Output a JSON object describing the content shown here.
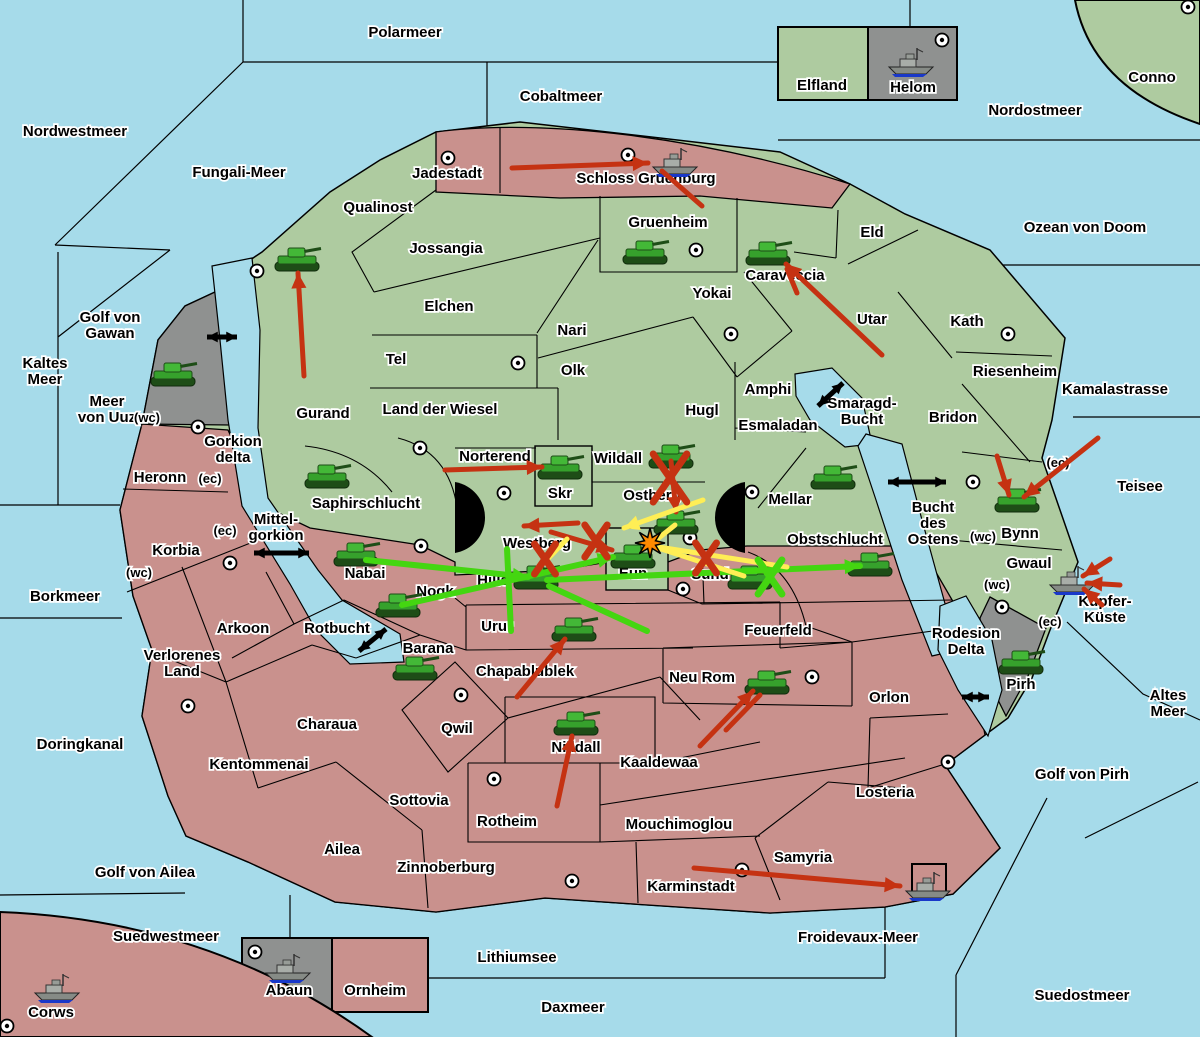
{
  "colors": {
    "sea": "#A6DBEA",
    "land_green": "#AECBA0",
    "land_pink": "#C9918D",
    "land_gray": "#8F9190",
    "border": "#000000",
    "halo": "#FFFFFF",
    "text": "#000000",
    "attack_red": "#C53212",
    "attack_green": "#44D611",
    "attack_yellow": "#FFEE55",
    "strait_black": "#000000",
    "explosion": "#FF8A00",
    "ship_blue": "#1938C9"
  },
  "sea_labels": [
    {
      "name": "Nordwestmeer",
      "x": 75,
      "y": 136
    },
    {
      "name": "Polarmeer",
      "x": 405,
      "y": 37
    },
    {
      "name": "Cobaltmeer",
      "x": 561,
      "y": 101
    },
    {
      "name": "Fungali-Meer",
      "x": 239,
      "y": 177
    },
    {
      "name": "Nordostmeer",
      "x": 1035,
      "y": 115
    },
    {
      "name": "Ozean von Doom",
      "x": 1085,
      "y": 232
    },
    {
      "name": "Golf von Gawan",
      "x": 110,
      "y": 322,
      "lines": [
        "Golf von",
        "Gawan"
      ]
    },
    {
      "name": "Kaltes Meer",
      "x": 45,
      "y": 368,
      "lines": [
        "Kaltes",
        "Meer"
      ]
    },
    {
      "name": "Meer von Uuz",
      "x": 107,
      "y": 406,
      "lines": [
        "Meer",
        "von Uuz"
      ]
    },
    {
      "name": "Gorkion delta",
      "x": 233,
      "y": 446,
      "lines": [
        "Gorkion",
        "delta"
      ]
    },
    {
      "name": "Mittel-gorkion",
      "x": 276,
      "y": 524,
      "lines": [
        "Mittel-",
        "gorkion"
      ]
    },
    {
      "name": "Borkmeer",
      "x": 65,
      "y": 601
    },
    {
      "name": "Rotbucht",
      "x": 337,
      "y": 633
    },
    {
      "name": "Smaragd-Bucht",
      "x": 862,
      "y": 408,
      "lines": [
        "Smaragd-",
        "Bucht"
      ]
    },
    {
      "name": "Bucht des Ostens",
      "x": 933,
      "y": 512,
      "lines": [
        "Bucht",
        "des",
        "Ostens"
      ]
    },
    {
      "name": "Kamalastrasse",
      "x": 1115,
      "y": 394
    },
    {
      "name": "Teisee",
      "x": 1140,
      "y": 491
    },
    {
      "name": "Kupfer-Küste",
      "x": 1105,
      "y": 606,
      "lines": [
        "Kupfer-",
        "Küste"
      ]
    },
    {
      "name": "Altes Meer",
      "x": 1168,
      "y": 700,
      "lines": [
        "Altes",
        "Meer"
      ]
    },
    {
      "name": "Rodesion Delta",
      "x": 966,
      "y": 638,
      "lines": [
        "Rodesion",
        "Delta"
      ]
    },
    {
      "name": "Golf von Pirh",
      "x": 1082,
      "y": 779
    },
    {
      "name": "Doringkanal",
      "x": 80,
      "y": 749
    },
    {
      "name": "Golf von Ailea",
      "x": 145,
      "y": 877
    },
    {
      "name": "Suedwestmeer",
      "x": 166,
      "y": 941
    },
    {
      "name": "Lithiumsee",
      "x": 517,
      "y": 962
    },
    {
      "name": "Daxmeer",
      "x": 573,
      "y": 1012
    },
    {
      "name": "Froidevaux-Meer",
      "x": 858,
      "y": 942
    },
    {
      "name": "Suedostmeer",
      "x": 1082,
      "y": 1000
    }
  ],
  "territory_labels": [
    {
      "name": "Jadestadt",
      "x": 447,
      "y": 178
    },
    {
      "name": "Schloss Gruenburg",
      "x": 646,
      "y": 183
    },
    {
      "name": "Elfland",
      "x": 822,
      "y": 90
    },
    {
      "name": "Helom",
      "x": 913,
      "y": 92
    },
    {
      "name": "Conno",
      "x": 1152,
      "y": 82
    },
    {
      "name": "Qualinost",
      "x": 378,
      "y": 212
    },
    {
      "name": "Jossangia",
      "x": 446,
      "y": 253
    },
    {
      "name": "Gruenheim",
      "x": 668,
      "y": 227
    },
    {
      "name": "Eld",
      "x": 872,
      "y": 237
    },
    {
      "name": "Caraveccia",
      "x": 785,
      "y": 280
    },
    {
      "name": "Yokai",
      "x": 712,
      "y": 298
    },
    {
      "name": "Utar",
      "x": 872,
      "y": 324
    },
    {
      "name": "Kath",
      "x": 967,
      "y": 326
    },
    {
      "name": "Riesenheim",
      "x": 1015,
      "y": 376
    },
    {
      "name": "Bridon",
      "x": 953,
      "y": 422
    },
    {
      "name": "Elchen",
      "x": 449,
      "y": 311
    },
    {
      "name": "Nari",
      "x": 572,
      "y": 335
    },
    {
      "name": "Tel",
      "x": 396,
      "y": 364
    },
    {
      "name": "Olk",
      "x": 573,
      "y": 375
    },
    {
      "name": "Land der Wiesel",
      "x": 440,
      "y": 414
    },
    {
      "name": "Hugl",
      "x": 702,
      "y": 415
    },
    {
      "name": "Amphi",
      "x": 768,
      "y": 394
    },
    {
      "name": "Esmaladan",
      "x": 778,
      "y": 430
    },
    {
      "name": "Gurand",
      "x": 323,
      "y": 418
    },
    {
      "name": "Norterend",
      "x": 495,
      "y": 461
    },
    {
      "name": "Skr",
      "x": 560,
      "y": 498
    },
    {
      "name": "Wildall",
      "x": 618,
      "y": 463
    },
    {
      "name": "Ostberg",
      "x": 652,
      "y": 500
    },
    {
      "name": "Mellar",
      "x": 790,
      "y": 504
    },
    {
      "name": "Westberg",
      "x": 537,
      "y": 548
    },
    {
      "name": "Eun",
      "x": 633,
      "y": 578
    },
    {
      "name": "Sund",
      "x": 710,
      "y": 579
    },
    {
      "name": "Saphirschlucht",
      "x": 366,
      "y": 508
    },
    {
      "name": "Nabai",
      "x": 365,
      "y": 578
    },
    {
      "name": "Nogk",
      "x": 435,
      "y": 596
    },
    {
      "name": "Hills",
      "x": 493,
      "y": 585
    },
    {
      "name": "Obstschlucht",
      "x": 835,
      "y": 544
    },
    {
      "name": "Bynn",
      "x": 1020,
      "y": 538
    },
    {
      "name": "Gwaul",
      "x": 1029,
      "y": 568
    },
    {
      "name": "Pirh",
      "x": 1021,
      "y": 689
    },
    {
      "name": "Heronn",
      "x": 160,
      "y": 482
    },
    {
      "name": "Korbia",
      "x": 176,
      "y": 555
    },
    {
      "name": "Arkoon",
      "x": 243,
      "y": 633
    },
    {
      "name": "Verlorenes Land",
      "x": 182,
      "y": 660,
      "lines": [
        "Verlorenes",
        "Land"
      ]
    },
    {
      "name": "Kentommenai",
      "x": 259,
      "y": 769
    },
    {
      "name": "Charaua",
      "x": 327,
      "y": 729
    },
    {
      "name": "Ailea",
      "x": 342,
      "y": 854
    },
    {
      "name": "Sottovia",
      "x": 419,
      "y": 805
    },
    {
      "name": "Zinnoberburg",
      "x": 446,
      "y": 872
    },
    {
      "name": "Qwil",
      "x": 457,
      "y": 733
    },
    {
      "name": "Rotheim",
      "x": 507,
      "y": 826
    },
    {
      "name": "Barana",
      "x": 428,
      "y": 653
    },
    {
      "name": "Urur",
      "x": 497,
      "y": 631
    },
    {
      "name": "Chapablublek",
      "x": 525,
      "y": 676
    },
    {
      "name": "Nilldall",
      "x": 576,
      "y": 752
    },
    {
      "name": "Kaaldewaa",
      "x": 659,
      "y": 767
    },
    {
      "name": "Neu Rom",
      "x": 702,
      "y": 682
    },
    {
      "name": "Feuerfeld",
      "x": 778,
      "y": 635
    },
    {
      "name": "Mouchimoglou",
      "x": 679,
      "y": 829
    },
    {
      "name": "Karminstadt",
      "x": 691,
      "y": 891
    },
    {
      "name": "Samyria",
      "x": 803,
      "y": 862
    },
    {
      "name": "Orlon",
      "x": 889,
      "y": 702
    },
    {
      "name": "Losteria",
      "x": 885,
      "y": 797
    },
    {
      "name": "Corws",
      "x": 51,
      "y": 1017
    },
    {
      "name": "Abaun",
      "x": 289,
      "y": 995
    },
    {
      "name": "Ornheim",
      "x": 375,
      "y": 995
    }
  ],
  "zone_markers": [
    {
      "text": "(wc)",
      "x": 147,
      "y": 422
    },
    {
      "text": "(ec)",
      "x": 210,
      "y": 483
    },
    {
      "text": "(ec)",
      "x": 225,
      "y": 535
    },
    {
      "text": "(wc)",
      "x": 139,
      "y": 577
    },
    {
      "text": "(wc)",
      "x": 983,
      "y": 541
    },
    {
      "text": "(ec)",
      "x": 1058,
      "y": 467
    },
    {
      "text": "(wc)",
      "x": 997,
      "y": 589
    },
    {
      "text": "(ec)",
      "x": 1050,
      "y": 626
    }
  ],
  "capital_dots": [
    [
      448,
      158
    ],
    [
      628,
      155
    ],
    [
      942,
      40
    ],
    [
      1188,
      7
    ],
    [
      257,
      271
    ],
    [
      198,
      427
    ],
    [
      518,
      363
    ],
    [
      731,
      334
    ],
    [
      1008,
      334
    ],
    [
      696,
      250
    ],
    [
      420,
      448
    ],
    [
      504,
      493
    ],
    [
      421,
      546
    ],
    [
      752,
      492
    ],
    [
      690,
      538
    ],
    [
      683,
      589
    ],
    [
      973,
      482
    ],
    [
      1002,
      607
    ],
    [
      230,
      563
    ],
    [
      188,
      706
    ],
    [
      461,
      695
    ],
    [
      494,
      779
    ],
    [
      572,
      881
    ],
    [
      742,
      870
    ],
    [
      812,
      677
    ],
    [
      948,
      762
    ],
    [
      7,
      1026
    ],
    [
      255,
      952
    ]
  ],
  "tanks": [
    [
      297,
      260
    ],
    [
      173,
      375
    ],
    [
      645,
      253
    ],
    [
      768,
      254
    ],
    [
      327,
      477
    ],
    [
      560,
      468
    ],
    [
      671,
      457
    ],
    [
      676,
      523
    ],
    [
      833,
      478
    ],
    [
      633,
      557
    ],
    [
      750,
      578
    ],
    [
      536,
      578
    ],
    [
      356,
      555
    ],
    [
      398,
      606
    ],
    [
      870,
      565
    ],
    [
      1017,
      501
    ],
    [
      1021,
      663
    ],
    [
      574,
      630
    ],
    [
      415,
      669
    ],
    [
      576,
      724
    ],
    [
      767,
      683
    ]
  ],
  "ships": [
    [
      675,
      162
    ],
    [
      911,
      62
    ],
    [
      1072,
      580
    ],
    [
      928,
      886
    ],
    [
      57,
      988
    ],
    [
      288,
      968
    ]
  ],
  "strait_arrows": [
    [
      207,
      337,
      237,
      337
    ],
    [
      818,
      406,
      843,
      383
    ],
    [
      888,
      482,
      946,
      482
    ],
    [
      254,
      553,
      309,
      553
    ],
    [
      359,
      651,
      386,
      629
    ],
    [
      962,
      697,
      989,
      697
    ]
  ],
  "attack_arrows": [
    {
      "color": "red",
      "x1": 512,
      "y1": 168,
      "x2": 648,
      "y2": 163,
      "head": true
    },
    {
      "color": "red",
      "x1": 702,
      "y1": 206,
      "x2": 662,
      "y2": 171,
      "head": false
    },
    {
      "color": "red",
      "x1": 304,
      "y1": 376,
      "x2": 298,
      "y2": 273,
      "head": true
    },
    {
      "color": "red",
      "x1": 882,
      "y1": 355,
      "x2": 786,
      "y2": 264,
      "head": true
    },
    {
      "color": "red",
      "x1": 797,
      "y1": 293,
      "x2": 787,
      "y2": 269,
      "head": false
    },
    {
      "color": "red",
      "x1": 445,
      "y1": 470,
      "x2": 542,
      "y2": 467,
      "head": true
    },
    {
      "color": "red",
      "x1": 671,
      "y1": 461,
      "x2": 676,
      "y2": 512,
      "head": true
    },
    {
      "color": "red",
      "x1": 578,
      "y1": 523,
      "x2": 524,
      "y2": 526,
      "head": true
    },
    {
      "color": "red",
      "x1": 551,
      "y1": 532,
      "x2": 612,
      "y2": 550,
      "head": true
    },
    {
      "color": "red",
      "x1": 997,
      "y1": 456,
      "x2": 1009,
      "y2": 495,
      "head": true
    },
    {
      "color": "red",
      "x1": 1098,
      "y1": 438,
      "x2": 1024,
      "y2": 497,
      "head": true
    },
    {
      "color": "red",
      "x1": 1110,
      "y1": 559,
      "x2": 1083,
      "y2": 576,
      "head": true
    },
    {
      "color": "red",
      "x1": 1120,
      "y1": 585,
      "x2": 1087,
      "y2": 583,
      "head": true
    },
    {
      "color": "red",
      "x1": 1102,
      "y1": 605,
      "x2": 1084,
      "y2": 589,
      "head": true
    },
    {
      "color": "red",
      "x1": 517,
      "y1": 697,
      "x2": 565,
      "y2": 639,
      "head": true
    },
    {
      "color": "red",
      "x1": 557,
      "y1": 806,
      "x2": 572,
      "y2": 736,
      "head": true
    },
    {
      "color": "red",
      "x1": 700,
      "y1": 746,
      "x2": 753,
      "y2": 691,
      "head": true
    },
    {
      "color": "red",
      "x1": 726,
      "y1": 730,
      "x2": 760,
      "y2": 695,
      "head": false
    },
    {
      "color": "red",
      "x1": 694,
      "y1": 868,
      "x2": 900,
      "y2": 886,
      "head": true
    },
    {
      "color": "green",
      "x1": 366,
      "y1": 560,
      "x2": 528,
      "y2": 577,
      "head": true
    },
    {
      "color": "green",
      "x1": 402,
      "y1": 605,
      "x2": 613,
      "y2": 557,
      "head": true
    },
    {
      "color": "green",
      "x1": 547,
      "y1": 580,
      "x2": 860,
      "y2": 566,
      "head": true
    },
    {
      "color": "green",
      "x1": 507,
      "y1": 549,
      "x2": 511,
      "y2": 631,
      "head": false
    },
    {
      "color": "green",
      "x1": 549,
      "y1": 586,
      "x2": 647,
      "y2": 631,
      "head": false
    },
    {
      "color": "yellow",
      "x1": 703,
      "y1": 500,
      "x2": 624,
      "y2": 528,
      "head": true
    },
    {
      "color": "yellow",
      "x1": 655,
      "y1": 541,
      "x2": 675,
      "y2": 525,
      "head": false
    },
    {
      "color": "yellow",
      "x1": 652,
      "y1": 546,
      "x2": 787,
      "y2": 567,
      "head": false
    },
    {
      "color": "yellow",
      "x1": 652,
      "y1": 546,
      "x2": 744,
      "y2": 576,
      "head": false
    },
    {
      "color": "yellow",
      "x1": 536,
      "y1": 571,
      "x2": 567,
      "y2": 539,
      "head": false
    }
  ],
  "crosses": [
    {
      "color": "red",
      "x": 670,
      "y": 478,
      "size": 24
    },
    {
      "color": "red",
      "x": 596,
      "y": 541,
      "size": 16
    },
    {
      "color": "red",
      "x": 545,
      "y": 559,
      "size": 15
    },
    {
      "color": "red",
      "x": 706,
      "y": 558,
      "size": 15
    },
    {
      "color": "green",
      "x": 770,
      "y": 577,
      "size": 17
    }
  ],
  "explosion": {
    "x": 650,
    "y": 543
  }
}
